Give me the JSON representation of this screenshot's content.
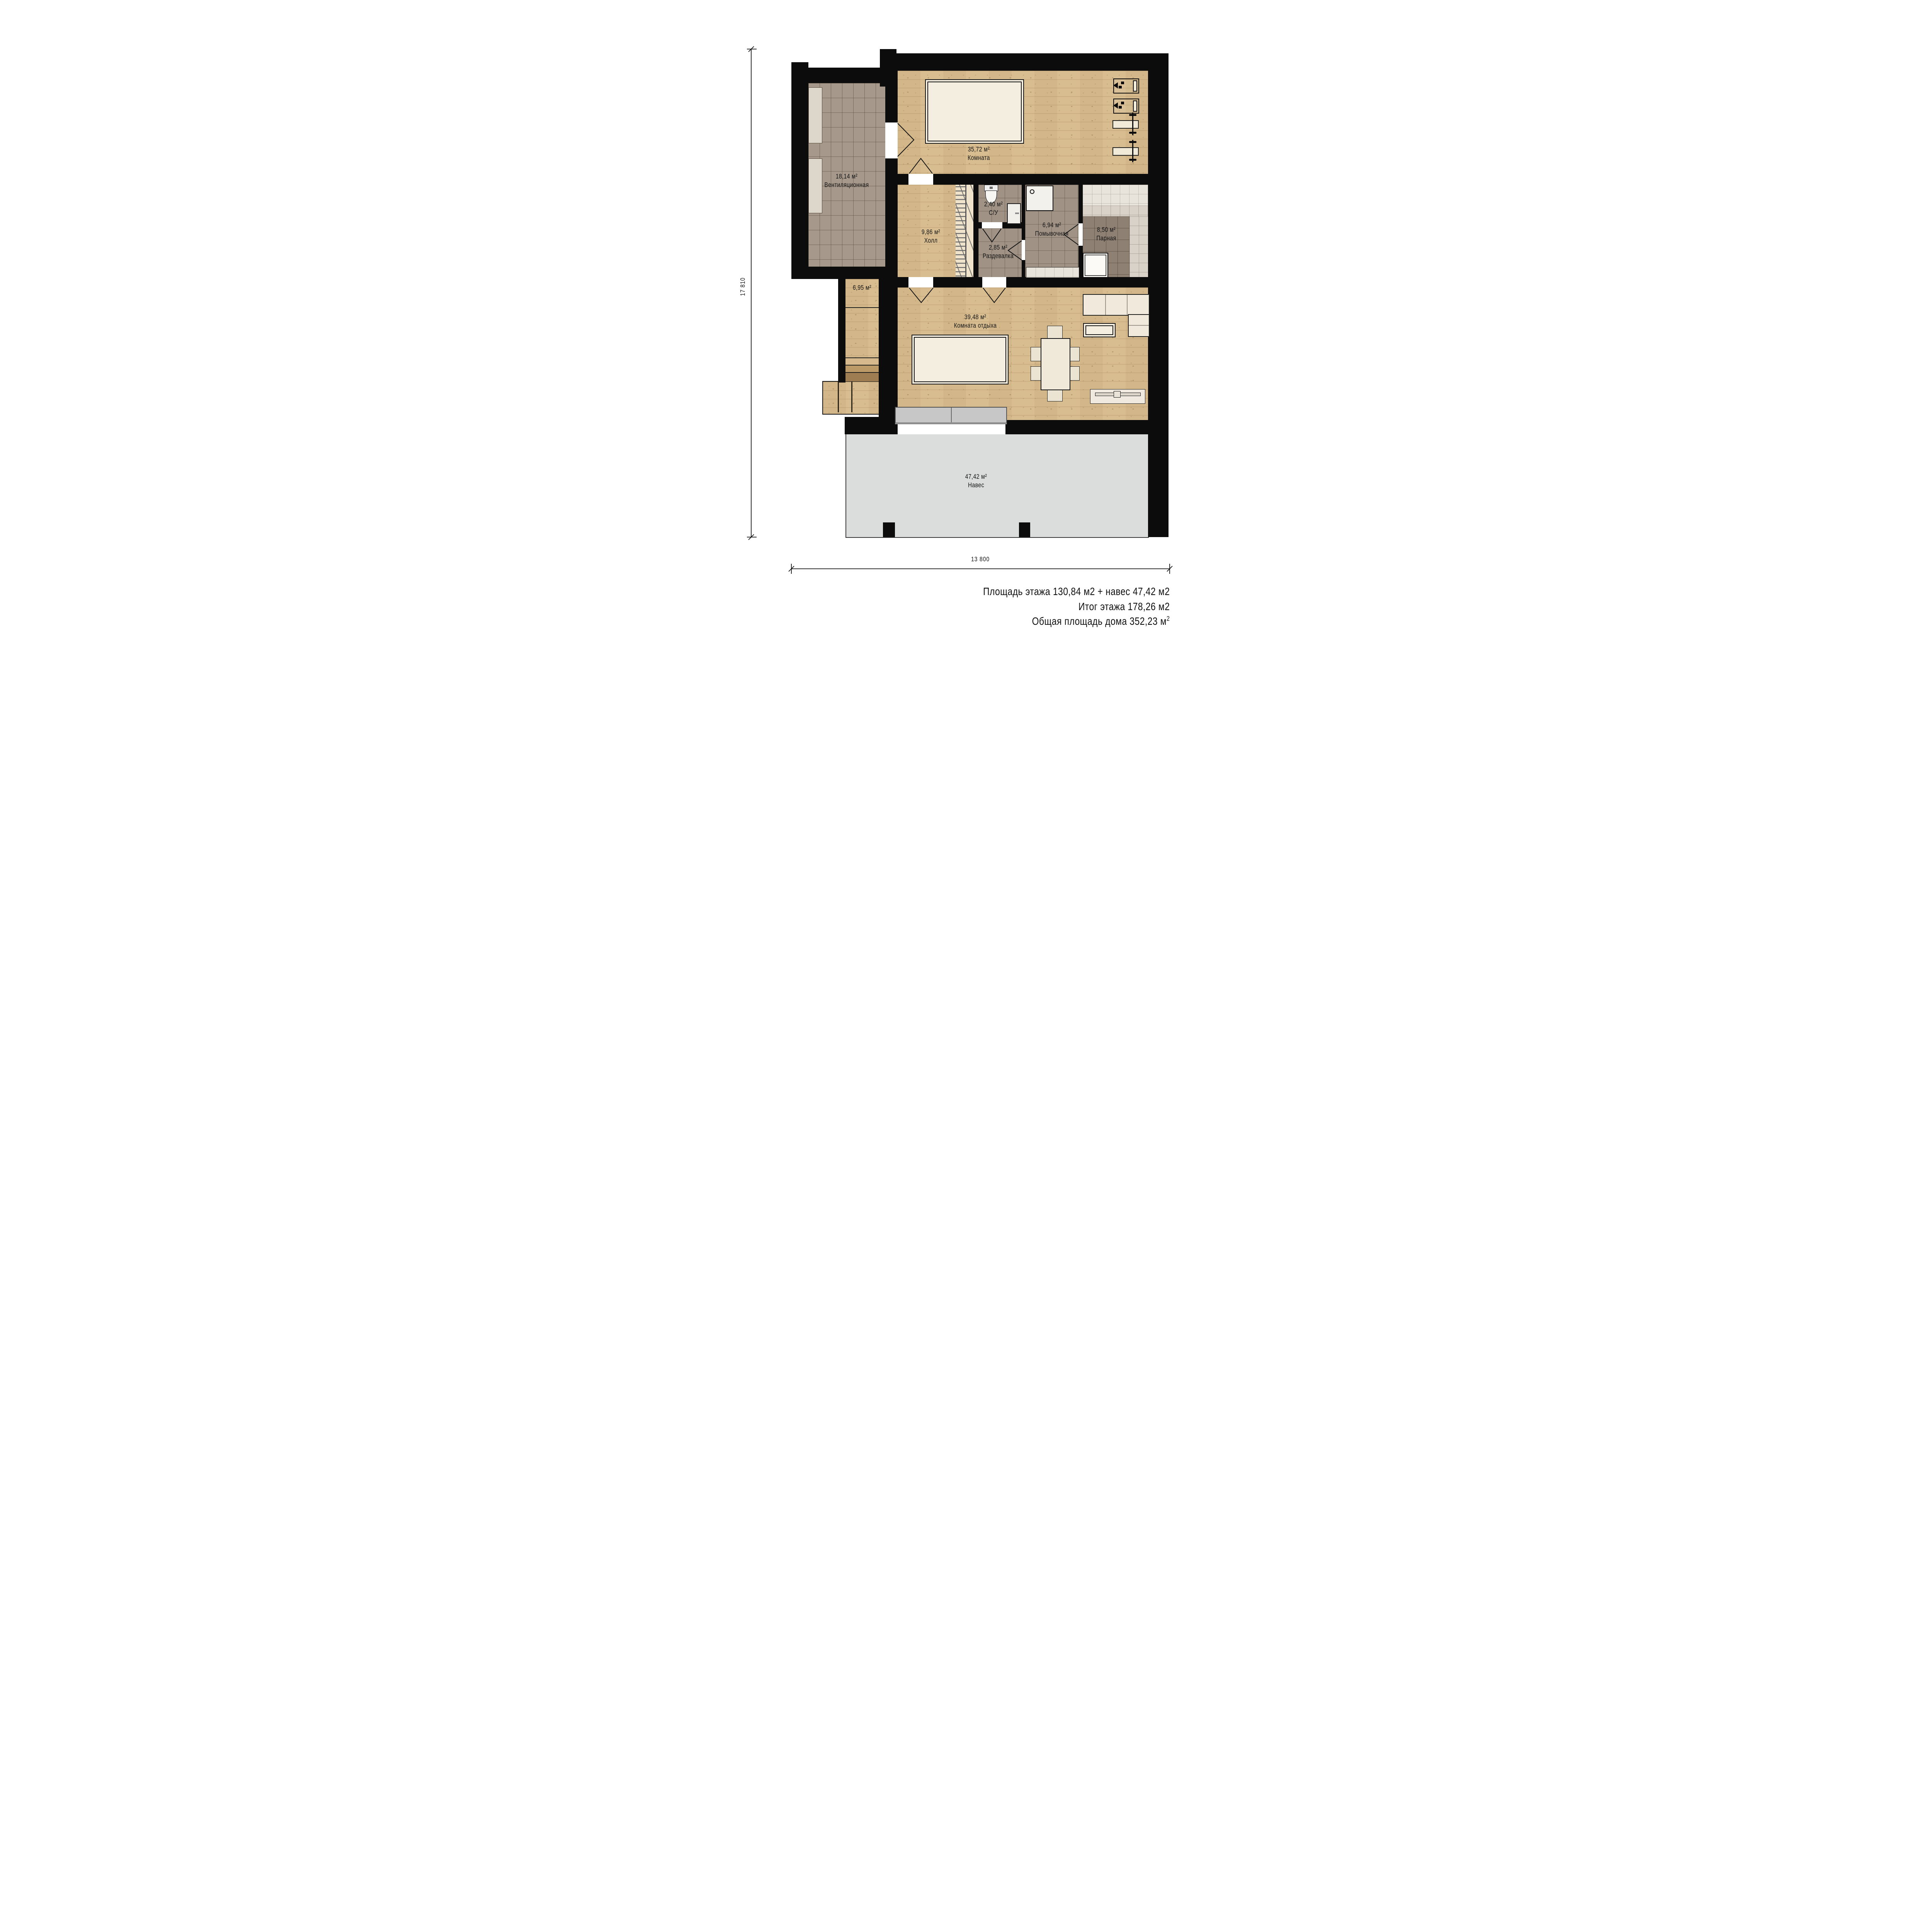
{
  "plan": {
    "rooms": [
      {
        "area": "18,14 м²",
        "name": "Вентиляционная"
      },
      {
        "area": "35,72 м²",
        "name": "Комната"
      },
      {
        "area": "2,40 м²",
        "name": "С/У"
      },
      {
        "area": "6,94 м²",
        "name": "Помывочная"
      },
      {
        "area": "8,50 м²",
        "name": "Парная"
      },
      {
        "area": "9,86 м²",
        "name": "Холл"
      },
      {
        "area": "2,85 м²",
        "name": "Раздевалка"
      },
      {
        "area": "6,95 м²",
        "name": ""
      },
      {
        "area": "39,48 м²",
        "name": "Комната отдыха"
      },
      {
        "area": "47,42 м²",
        "name": "Навес"
      }
    ],
    "dimensions": {
      "left": "17 810",
      "bottom": "13 800"
    },
    "summary": {
      "line1": "Площадь этажа 130,84 м2 + навес 47,42 м2",
      "line2": "Итог этажа 178,26 м2",
      "line3_base": "Общая площадь дома 352,23 м",
      "line3_sup": "2"
    },
    "palette": {
      "wall": "#0c0c0c",
      "wood": "#d8bd90",
      "tile_ventilation": "#a6988b",
      "tile_wet": "#a09386",
      "sauna_floor": "#8e8073",
      "bench_tile": "#d9d2c8",
      "canopy": "#dbdcdc",
      "counter": "#c7c7c7"
    }
  }
}
